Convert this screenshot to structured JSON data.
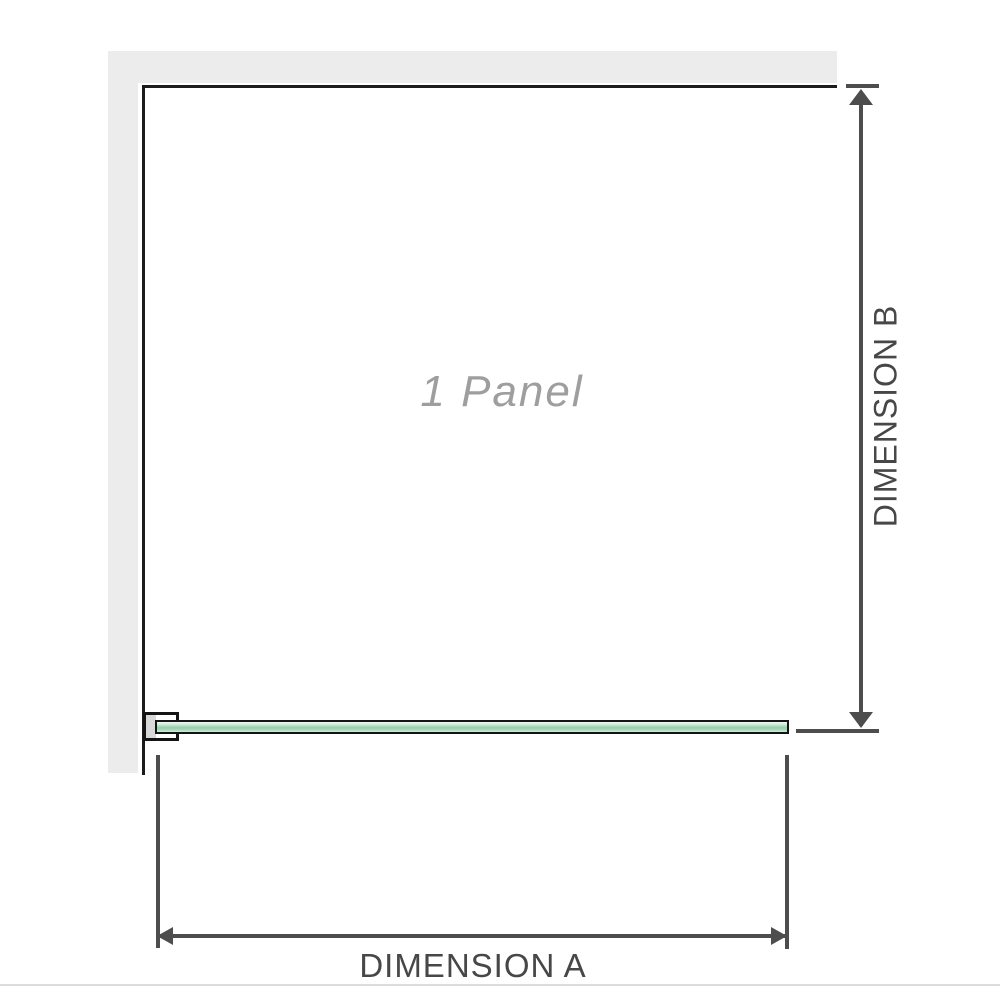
{
  "diagram": {
    "title": "Shower screen single panel plan-view diagram",
    "panel_label": "1 Panel",
    "dimension_a": {
      "label": "DIMENSION A",
      "orientation": "horizontal",
      "measures": "glass panel width"
    },
    "dimension_b": {
      "label": "DIMENSION B",
      "orientation": "vertical",
      "measures": "depth from back wall to glass panel"
    }
  },
  "colors": {
    "background": "#ffffff",
    "wall_fill": "#ececec",
    "wall_edge": "#1c1c1c",
    "glass_outline": "#141414",
    "glass_green_mid": "#93cfac",
    "glass_green_light": "#eef7f1",
    "bracket_fill": "#d8d8d8",
    "dimension_line": "#4d4d4d",
    "dimension_text": "#474747",
    "panel_label_text": "#9e9e9e",
    "bottom_rule": "#dcdcdc"
  }
}
